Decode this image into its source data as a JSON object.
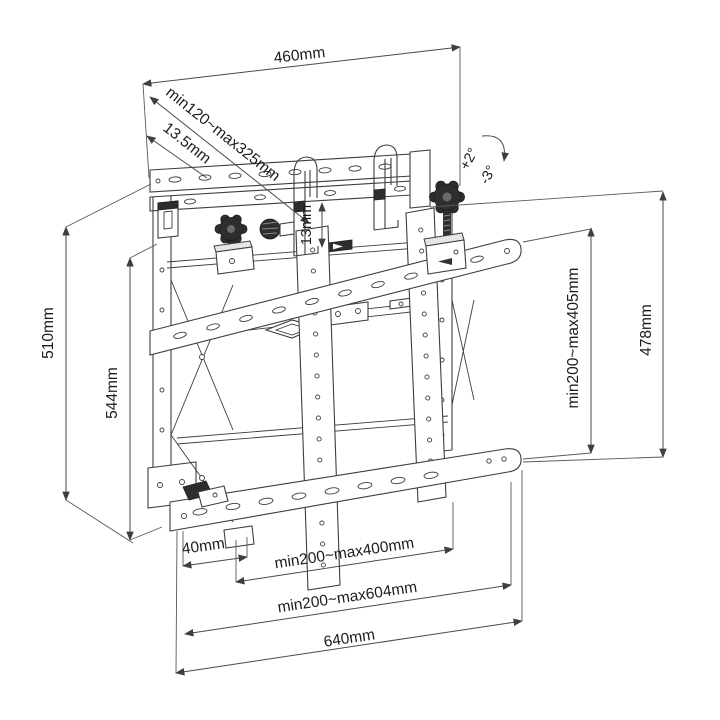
{
  "diagram": {
    "subject": "TV video-wall mount bracket dimensional drawing",
    "colors": {
      "line": "#3d3d3d",
      "dim_line": "#4a4a4a",
      "text": "#1c1c1c",
      "background": "#ffffff"
    },
    "dims": {
      "top_width": "460mm",
      "depth_range": "min120~max325mm",
      "plate_thickness": "13.5mm",
      "tilt_up": "+2°",
      "tilt_down": "-3°",
      "rail_gap": "13mm",
      "left_outer_height": "510mm",
      "left_inner_height": "544mm",
      "right_inner_height": "min200~max405mm",
      "right_outer_height": "478mm",
      "bottom_offset": "40mm",
      "bottom_inner_width": "min200~max400mm",
      "bottom_middle_width": "min200~max604mm",
      "bottom_outer_width": "640mm"
    }
  }
}
